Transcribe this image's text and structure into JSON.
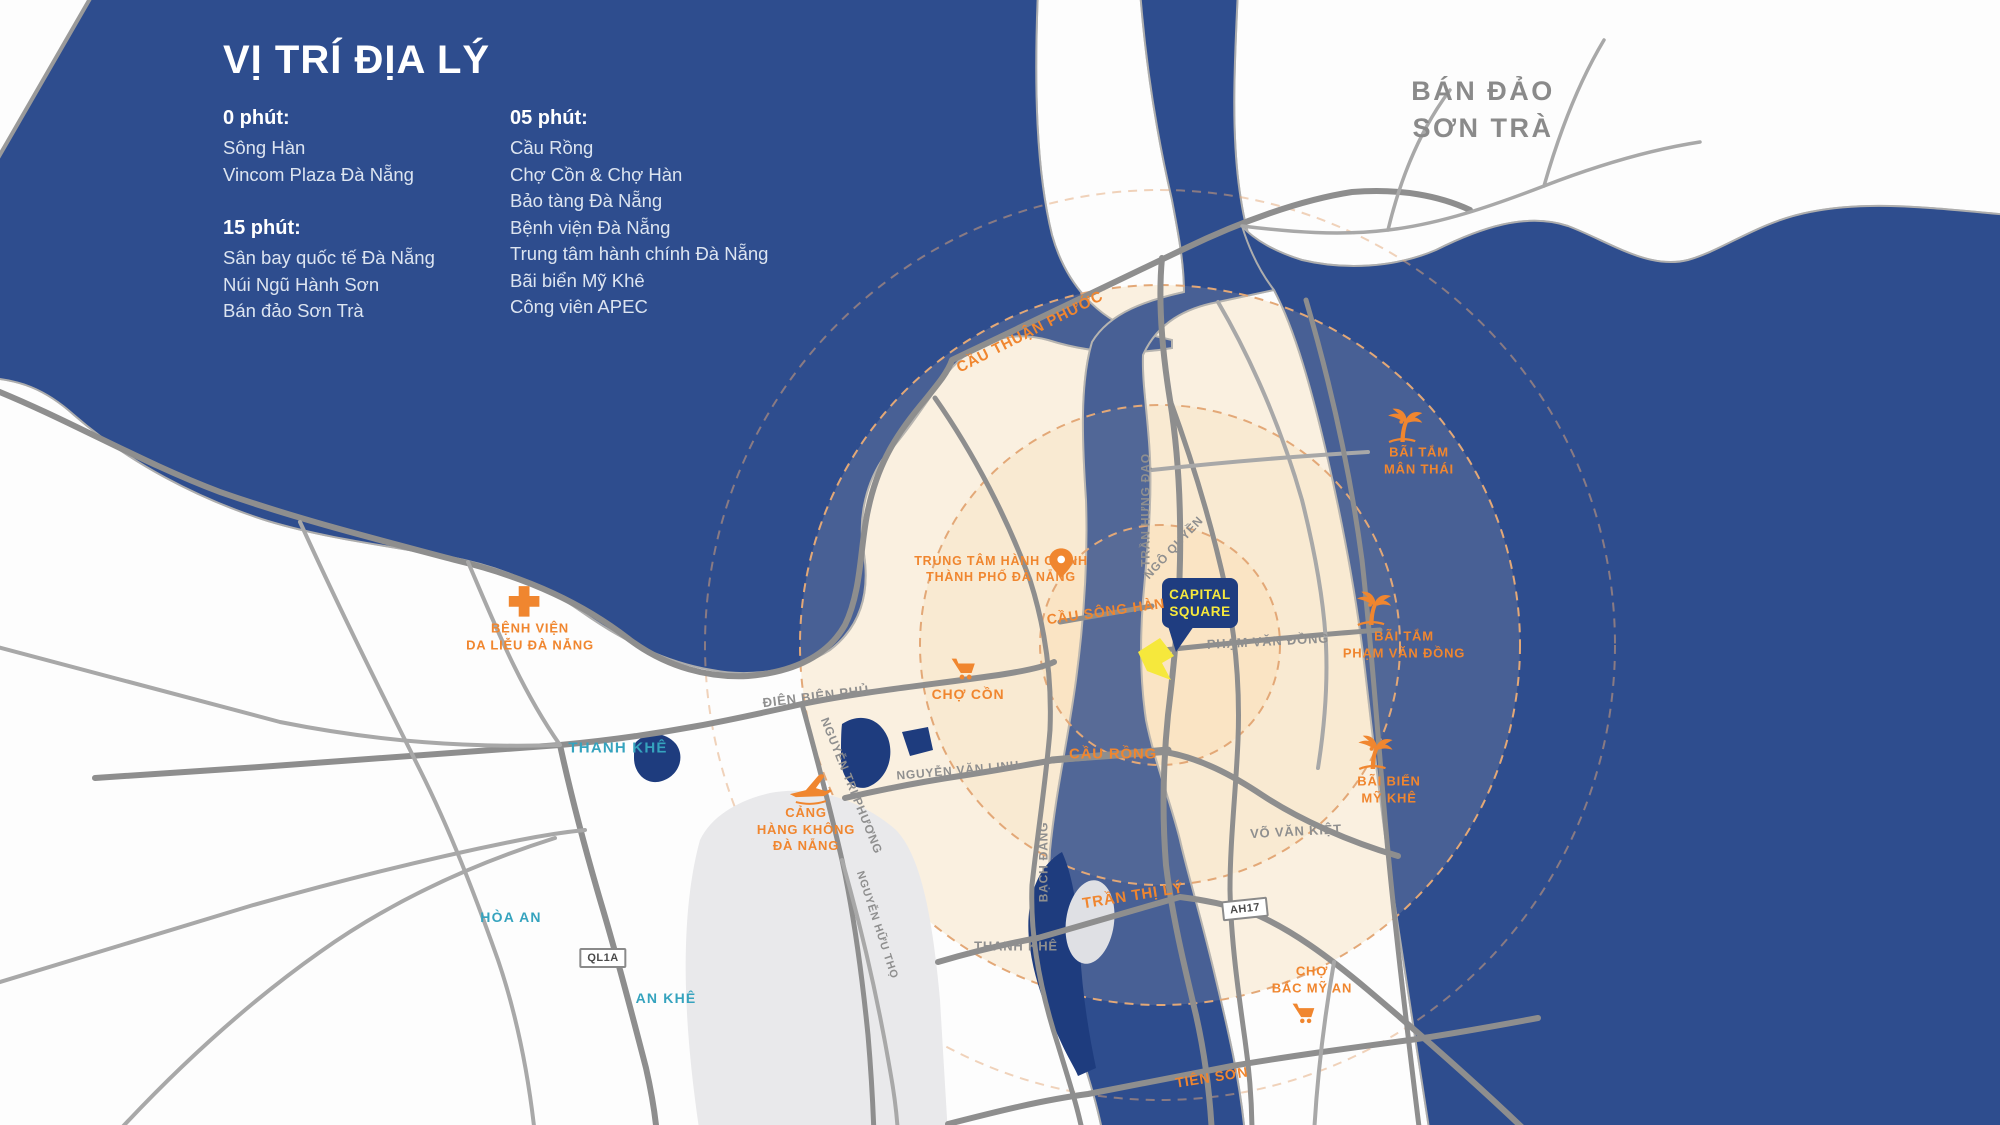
{
  "colors": {
    "sea": "#2E4D8E",
    "river_south": "#1E3C7E",
    "orange": "#F0862F",
    "teal": "#35A3BE",
    "gray_label": "#8F8F8F",
    "road_gray": "#8E8E8E",
    "ring_dash": "#E3A877",
    "navy_bubble": "#1F3D80",
    "project_yellow": "#F6E83C"
  },
  "info_panel": {
    "title": "VỊ TRÍ ĐỊA LÝ",
    "columns": [
      {
        "groups": [
          {
            "heading": "0 phút:",
            "items": [
              "Sông Hàn",
              "Vincom Plaza Đà Nẵng"
            ]
          },
          {
            "heading": "15 phút:",
            "items": [
              "Sân bay quốc tế Đà Nẵng",
              "Núi Ngũ Hành Sơn",
              "Bán đảo Sơn Trà"
            ]
          }
        ]
      },
      {
        "groups": [
          {
            "heading": "05 phút:",
            "items": [
              "Cầu Rồng",
              "Chợ Cồn & Chợ Hàn",
              "Bảo tàng Đà Nẵng",
              "Bệnh viện Đà Nẵng",
              "Trung tâm hành chính Đà Nẵng",
              "Bãi biển Mỹ Khê",
              "Công viên APEC"
            ]
          }
        ]
      }
    ]
  },
  "peninsula_label": {
    "text": "BÁN ĐẢO\nSƠN TRÀ"
  },
  "project": {
    "line1": "CAPITAL",
    "line2": "SQUARE"
  },
  "map_labels": [
    {
      "name": "cau-thuan-phuoc-label",
      "text": "CẦU THUẬN PHƯỚC",
      "x": 1030,
      "y": 332,
      "size": 15,
      "style": "orange",
      "rot": -27
    },
    {
      "name": "admin-center-label",
      "text": "TRUNG TÂM HÀNH CHÍNH\nTHÀNH PHỐ ĐÀ NẴNG",
      "x": 1001,
      "y": 569,
      "size": 12.5,
      "style": "orange",
      "icon": "pin",
      "icon_dx": 60,
      "icon_dy": -7,
      "icon_w": 34
    },
    {
      "name": "cau-song-han-label",
      "text": "CẦU SÔNG HÀN",
      "x": 1106,
      "y": 612,
      "size": 14,
      "style": "orange",
      "rot": -8
    },
    {
      "name": "pham-van-dong-road-label",
      "text": "PHẠM VĂN ĐỒNG",
      "x": 1268,
      "y": 642,
      "size": 13,
      "style": "gray",
      "rot": -3
    },
    {
      "name": "tran-hung-dao-road-label",
      "text": "TRẦN HƯNG ĐẠO",
      "x": 1146,
      "y": 510,
      "size": 12,
      "style": "gray",
      "rot": -90
    },
    {
      "name": "ngo-quyen-road-label",
      "text": "NGÔ QUYỀN",
      "x": 1174,
      "y": 548,
      "size": 12,
      "style": "gray",
      "rot": -47
    },
    {
      "name": "dien-bien-phu-road-label",
      "text": "ĐIỆN BIÊN PHỦ",
      "x": 816,
      "y": 697,
      "size": 13,
      "style": "gray",
      "rot": -7
    },
    {
      "name": "thanh-khe-west-label",
      "text": "THANH KHÊ",
      "x": 618,
      "y": 748,
      "size": 15,
      "style": "teal"
    },
    {
      "name": "cho-con-label",
      "text": "CHỢ CỒN",
      "x": 968,
      "y": 695,
      "size": 14,
      "style": "orange",
      "icon": "cart",
      "icon_dx": -4,
      "icon_dy": -26,
      "icon_w": 32
    },
    {
      "name": "benh-vien-da-lieu-label",
      "text": "BỆNH VIỆN\nDA LIỄU ĐÀ NẴNG",
      "x": 530,
      "y": 637,
      "size": 13,
      "style": "orange",
      "icon": "cross",
      "icon_dx": -6,
      "icon_dy": -36,
      "icon_w": 36
    },
    {
      "name": "nguyen-tri-phuong-road-label",
      "text": "NGUYỄN TRI PHƯƠNG",
      "x": 851,
      "y": 786,
      "size": 12,
      "style": "gray",
      "rot": 68
    },
    {
      "name": "cang-hang-khong-label",
      "text": "CẢNG\nHÀNG KHÔNG\nĐÀ NẴNG",
      "x": 806,
      "y": 830,
      "size": 13,
      "style": "orange",
      "icon": "plane",
      "icon_dx": 4,
      "icon_dy": -42,
      "icon_w": 48
    },
    {
      "name": "nguyen-van-linh-road-label",
      "text": "NGUYỄN VĂN LINH",
      "x": 958,
      "y": 771,
      "size": 12,
      "style": "gray",
      "rot": -5
    },
    {
      "name": "bach-dang-road-label",
      "text": "BẠCH ĐẰNG",
      "x": 1044,
      "y": 862,
      "size": 12,
      "style": "gray",
      "rot": -90
    },
    {
      "name": "cau-rong-label",
      "text": "CẦU RỒNG",
      "x": 1113,
      "y": 754,
      "size": 15,
      "style": "orange"
    },
    {
      "name": "vo-van-kiet-road-label",
      "text": "VÕ VĂN KIỆT",
      "x": 1296,
      "y": 832,
      "size": 13,
      "style": "gray",
      "rot": -3
    },
    {
      "name": "tran-thi-ly-label",
      "text": "TRẦN THỊ LÝ",
      "x": 1133,
      "y": 896,
      "size": 15,
      "style": "orange",
      "rot": -9
    },
    {
      "name": "route-badge-ah17",
      "text": "AH17",
      "x": 1245,
      "y": 909,
      "size": 11,
      "style": "badge",
      "rot": -6
    },
    {
      "name": "thanh-khe-south-label",
      "text": "THANH KHÊ",
      "x": 1016,
      "y": 947,
      "size": 13,
      "style": "gray"
    },
    {
      "name": "cho-bac-my-an-label",
      "text": "CHỢ\nBẮC MỸ AN",
      "x": 1312,
      "y": 980,
      "size": 13,
      "style": "orange",
      "icon": "cart",
      "icon_dx": -8,
      "icon_dy": 33,
      "icon_w": 30
    },
    {
      "name": "tien-son-label",
      "text": "TIÊN SƠN",
      "x": 1212,
      "y": 1078,
      "size": 14,
      "style": "orange",
      "rot": -9
    },
    {
      "name": "hoa-an-label",
      "text": "HÒA AN",
      "x": 511,
      "y": 918,
      "size": 14,
      "style": "teal"
    },
    {
      "name": "route-badge-ql1a",
      "text": "QL1A",
      "x": 603,
      "y": 958,
      "size": 11,
      "style": "badge"
    },
    {
      "name": "an-khe-label",
      "text": "AN KHÊ",
      "x": 666,
      "y": 999,
      "size": 14,
      "style": "teal"
    },
    {
      "name": "bai-tam-man-thai-label",
      "text": "BÃI TẮM\nMÂN THÁI",
      "x": 1419,
      "y": 461,
      "size": 13,
      "style": "orange",
      "icon": "palm",
      "icon_dx": -16,
      "icon_dy": -36,
      "icon_w": 42
    },
    {
      "name": "bai-tam-pham-van-dong-label",
      "text": "BÃI TẮM\nPHẠM VĂN ĐỒNG",
      "x": 1404,
      "y": 645,
      "size": 13,
      "style": "orange",
      "icon": "palm",
      "icon_dx": -32,
      "icon_dy": -37,
      "icon_w": 42
    },
    {
      "name": "bai-bien-my-khe-label",
      "text": "BÃI BIỂN\nMỸ KHÊ",
      "x": 1389,
      "y": 790,
      "size": 13,
      "style": "orange",
      "icon": "palm",
      "icon_dx": -16,
      "icon_dy": -38,
      "icon_w": 42
    },
    {
      "name": "nguyen-huu-tho-road-label",
      "text": "NGUYỄN HỮU THỌ",
      "x": 877,
      "y": 925,
      "size": 11,
      "style": "gray",
      "rot": 72
    }
  ]
}
